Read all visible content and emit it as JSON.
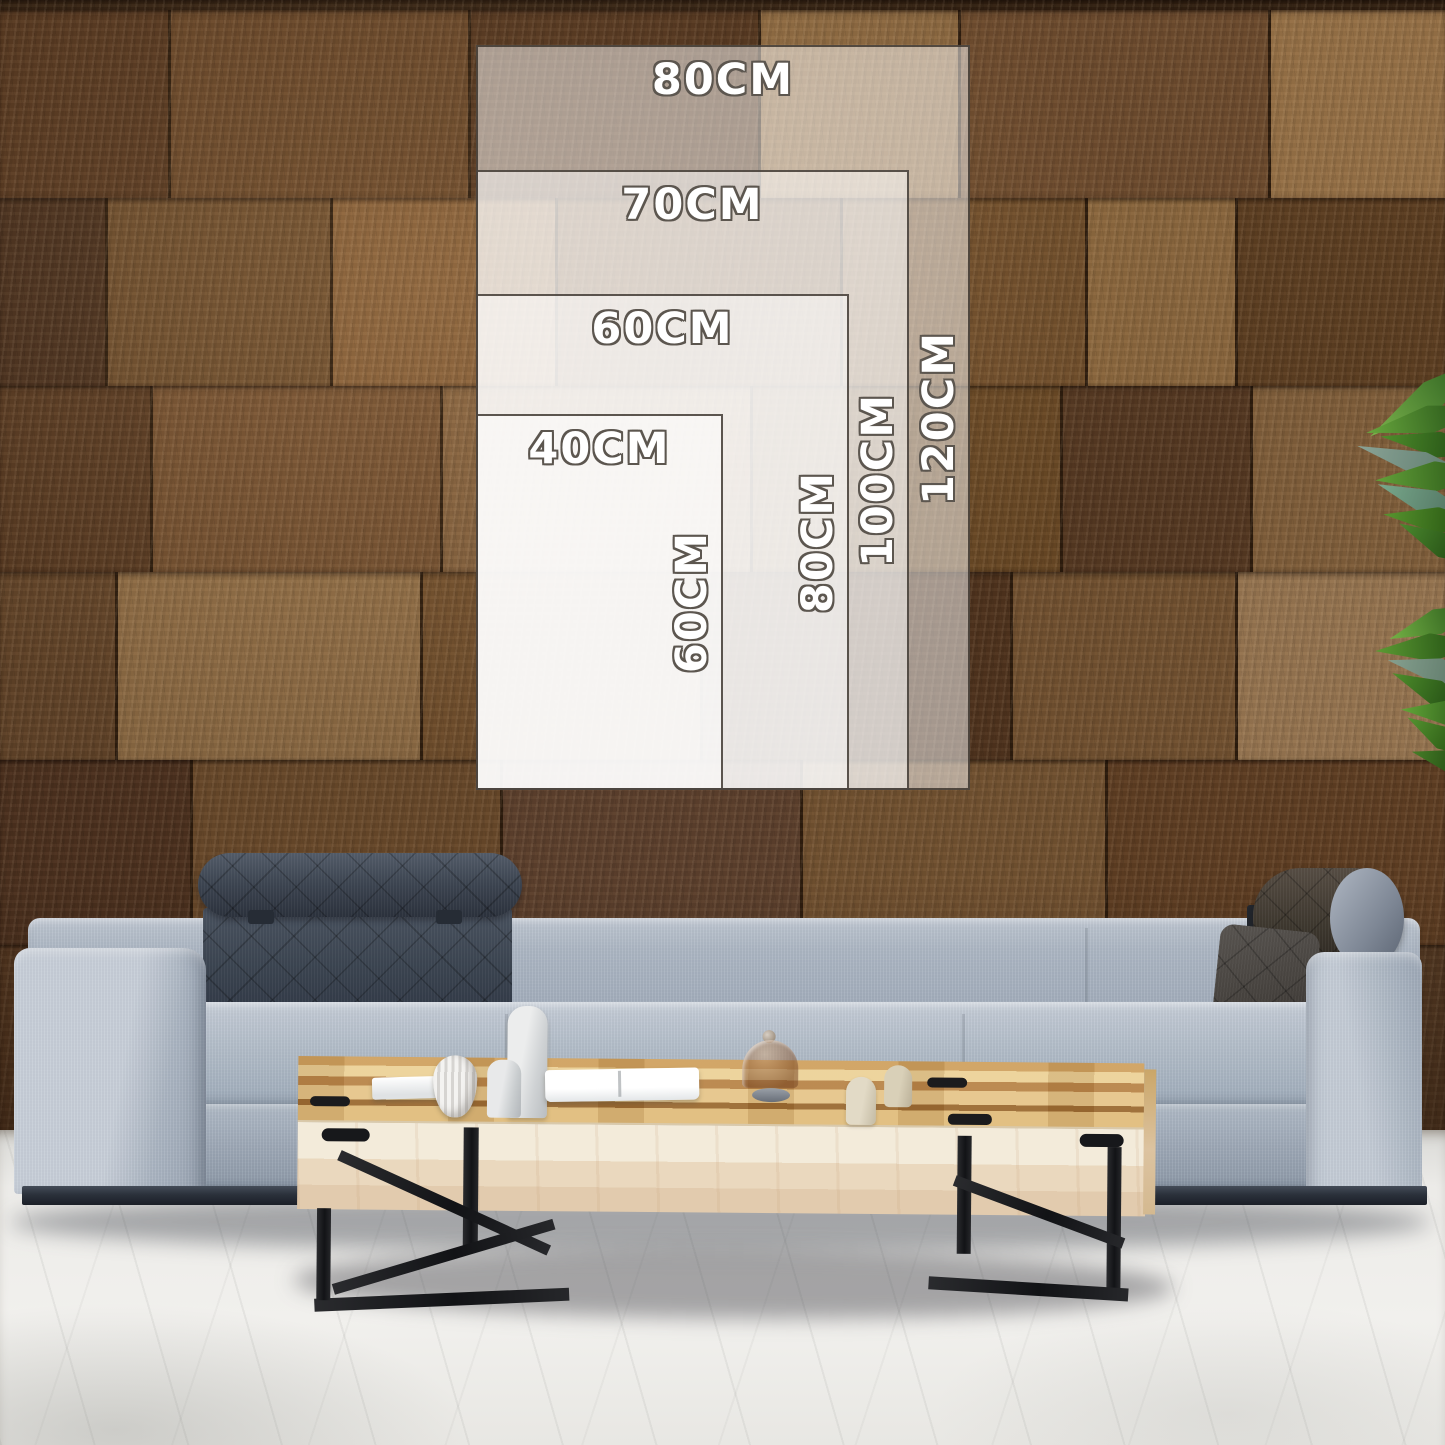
{
  "size_guide": {
    "sizes": [
      {
        "name": "80x120",
        "width_label": "80CM",
        "height_label": "120CM"
      },
      {
        "name": "70x100",
        "width_label": "70CM",
        "height_label": "100CM"
      },
      {
        "name": "60x80",
        "width_label": "60CM",
        "height_label": "80CM"
      },
      {
        "name": "40x60",
        "width_label": "40CM",
        "height_label": "60CM"
      }
    ],
    "label_text_color": "#ffffff",
    "label_outline_color": "#5c564f",
    "overlay_fill": "rgba(255,255,255,0.5)",
    "overlay_border": "#38312a"
  },
  "palette": {
    "wall_brown_dark": "#543622",
    "wall_brown_mid": "#74512f",
    "wall_brown_light": "#9a7347",
    "sofa_fabric": "#b5bcc7",
    "sofa_headrest_dark": "#3d4450",
    "sofa_bolster_brown": "#423a32",
    "table_wood": "#dcb77c",
    "table_front_cream": "#f1e9d8",
    "metal_black": "#17181a",
    "floor_concrete": "#eceae7",
    "plant_green": "#4c8a2f"
  }
}
